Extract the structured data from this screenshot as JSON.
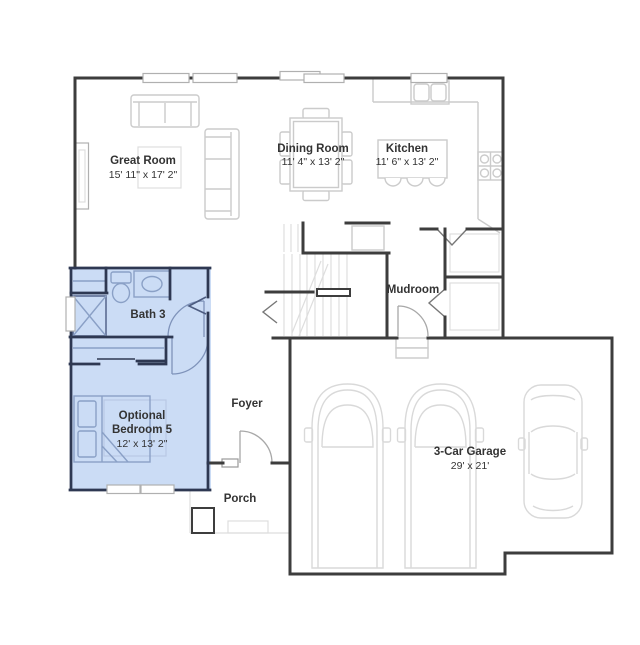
{
  "colors": {
    "highlight": "#cbdcf5",
    "wall": "#3d3d3d",
    "wall_blue": "#2e3852",
    "furniture": "#cbcbcb",
    "furniture_blue": "#8aa0c6",
    "text": "#333333"
  },
  "rooms": {
    "great_room": {
      "name": "Great Room",
      "dims": "15' 11\" x 17' 2\""
    },
    "dining_room": {
      "name": "Dining Room",
      "dims": "11' 4\" x 13' 2\""
    },
    "kitchen": {
      "name": "Kitchen",
      "dims": "11' 6\" x 13' 2\""
    },
    "mudroom": {
      "name": "Mudroom"
    },
    "bath3": {
      "name": "Bath 3"
    },
    "bedroom5": {
      "line1": "Optional",
      "line2": "Bedroom 5",
      "dims": "12' x 13' 2\""
    },
    "foyer": {
      "name": "Foyer"
    },
    "porch": {
      "name": "Porch"
    },
    "garage": {
      "name": "3-Car Garage",
      "dims": "29' x 21'"
    }
  }
}
